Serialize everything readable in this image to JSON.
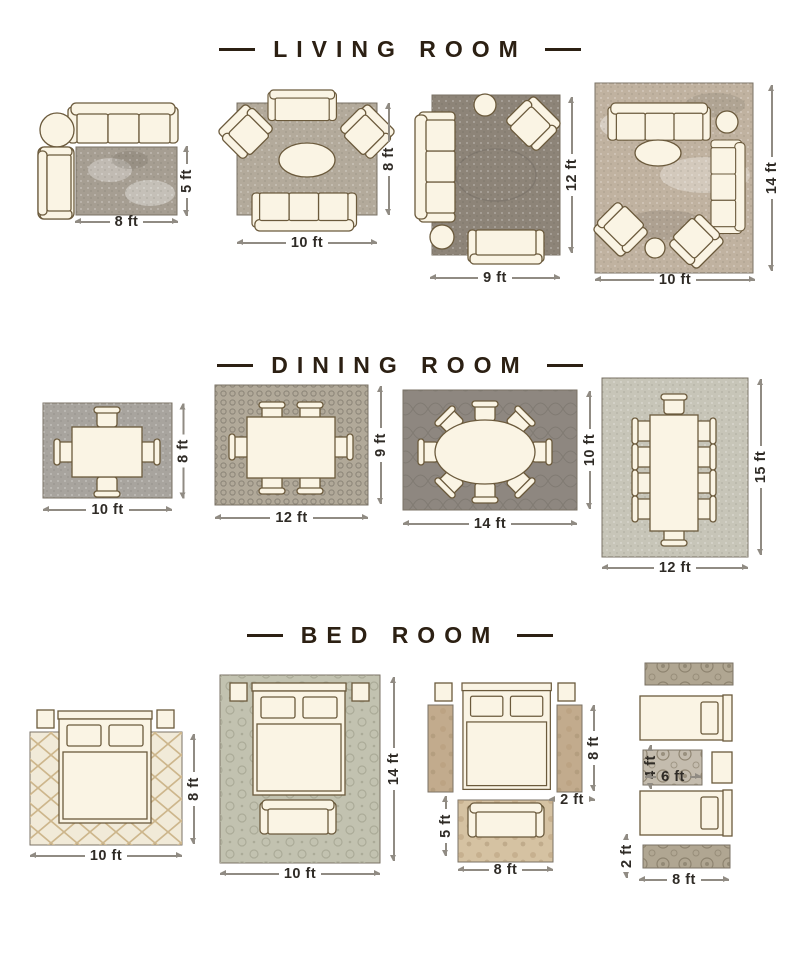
{
  "page": {
    "background": "#ffffff"
  },
  "colors": {
    "title": "#2c2013",
    "dimension_text": "#2f2b26",
    "dimension_line": "#908b83",
    "furniture_fill": "#faf4e4",
    "furniture_stroke": "#6b5a3c"
  },
  "sections": [
    {
      "title": "LIVING ROOM",
      "layouts": [
        {
          "id": "living-8x5",
          "rug_w": "8 ft",
          "rug_h": "5 ft",
          "rug_color": "#a69e92"
        },
        {
          "id": "living-10x8",
          "rug_w": "10 ft",
          "rug_h": "8 ft",
          "rug_color": "#b3aa9b"
        },
        {
          "id": "living-9x12",
          "rug_w": "9 ft",
          "rug_h": "12 ft",
          "rug_color": "#8d8478"
        },
        {
          "id": "living-10x14",
          "rug_w": "10 ft",
          "rug_h": "14 ft",
          "rug_color": "#c0b2a0"
        }
      ]
    },
    {
      "title": "DINING ROOM",
      "layouts": [
        {
          "id": "dining-10x8",
          "rug_w": "10 ft",
          "rug_h": "8 ft",
          "rug_color": "#a8a49e"
        },
        {
          "id": "dining-12x9",
          "rug_w": "12 ft",
          "rug_h": "9 ft",
          "rug_color": "#b1a999"
        },
        {
          "id": "dining-14x10",
          "rug_w": "14 ft",
          "rug_h": "10 ft",
          "rug_color": "#8e8780"
        },
        {
          "id": "dining-12x15",
          "rug_w": "12 ft",
          "rug_h": "15 ft",
          "rug_color": "#c7c5b8"
        }
      ]
    },
    {
      "title": "BED ROOM",
      "layouts": [
        {
          "id": "bed-10x8",
          "rug_w": "10 ft",
          "rug_h": "8 ft",
          "rug_color": "#f1ead8"
        },
        {
          "id": "bed-10x14",
          "rug_w": "10 ft",
          "rug_h": "14 ft",
          "rug_color": "#c2c2b0"
        },
        {
          "id": "bed-runners-8x5",
          "rug_w": "8 ft",
          "rug_h": "5 ft",
          "runner_h": "8 ft",
          "runner_w": "2 ft",
          "rug_color": "#d5c2a2",
          "runner_color": "#c2ab8d"
        },
        {
          "id": "bed-twin-8",
          "rug_w": "8 ft",
          "runner_h": "2 ft",
          "mid_w": "6 ft",
          "mid_h": "4 ft",
          "rug_color": "#c4bcae",
          "runner_color": "#b0a692"
        }
      ]
    }
  ]
}
